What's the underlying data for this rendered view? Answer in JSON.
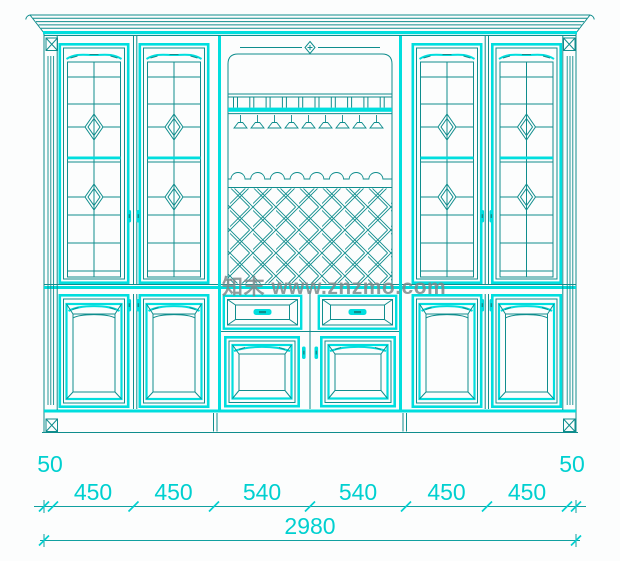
{
  "watermark": {
    "text": "知末 www.znzmo.com"
  },
  "colors": {
    "line_bright": "#00dede",
    "line_dark": "#0f8d8d",
    "dim_text": "#00d0d0",
    "dim_line": "#11a0a0",
    "watermark": "#7d8a8c",
    "background": "#fcfdfd"
  },
  "dimensions": {
    "left_overhang": "50",
    "right_overhang": "50",
    "segments": [
      "450",
      "450",
      "540",
      "540",
      "450",
      "450"
    ],
    "total": "2980"
  }
}
